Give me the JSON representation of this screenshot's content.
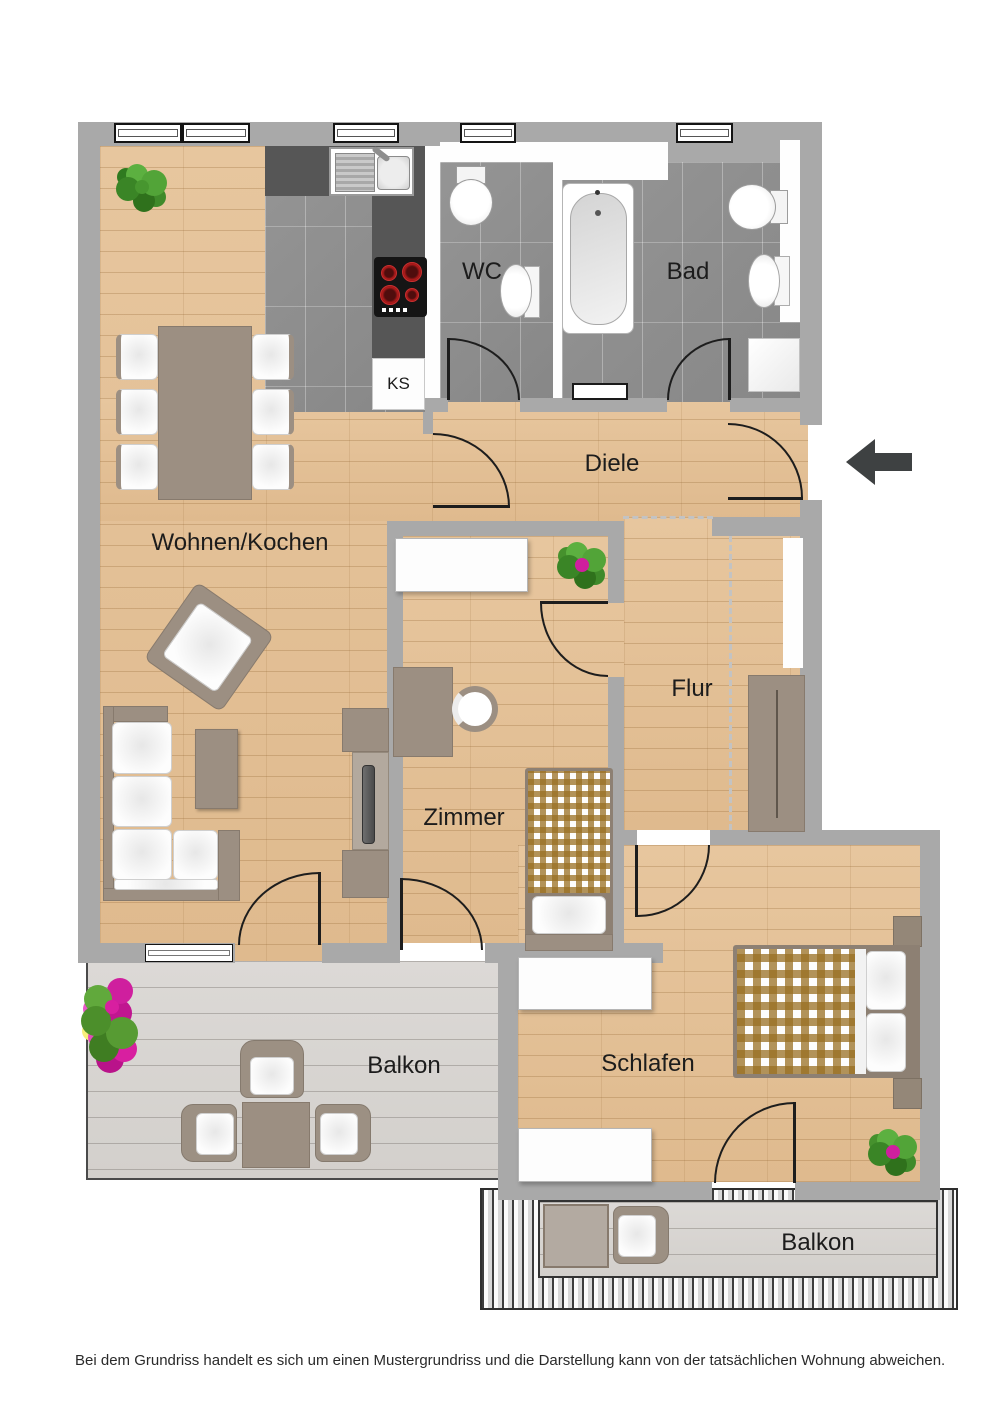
{
  "rooms": {
    "wc": "WC",
    "bad": "Bad",
    "diele": "Diele",
    "wohnen_kochen": "Wohnen/Kochen",
    "zimmer": "Zimmer",
    "flur": "Flur",
    "schlafen": "Schlafen",
    "balkon_left": "Balkon",
    "balkon_right": "Balkon"
  },
  "labels": {
    "ks": "KS"
  },
  "disclaimer": "Bei dem Grundriss handelt es sich um einen Mustergrundriss und die Darstellung kann von der tatsächlichen Wohnung abweichen.",
  "icons": {
    "entrance": "arrow-left"
  },
  "colors": {
    "wall": "#a9a9a9",
    "wood_floor": "#e4c29a",
    "tile_floor": "#8f8f8f",
    "balcony_deck": "#d9d6d2",
    "furniture_taupe": "#9c8f82",
    "kitchen_counter": "#565656",
    "entrance_arrow": "#3e4142",
    "bed_checker": "#996f22"
  }
}
